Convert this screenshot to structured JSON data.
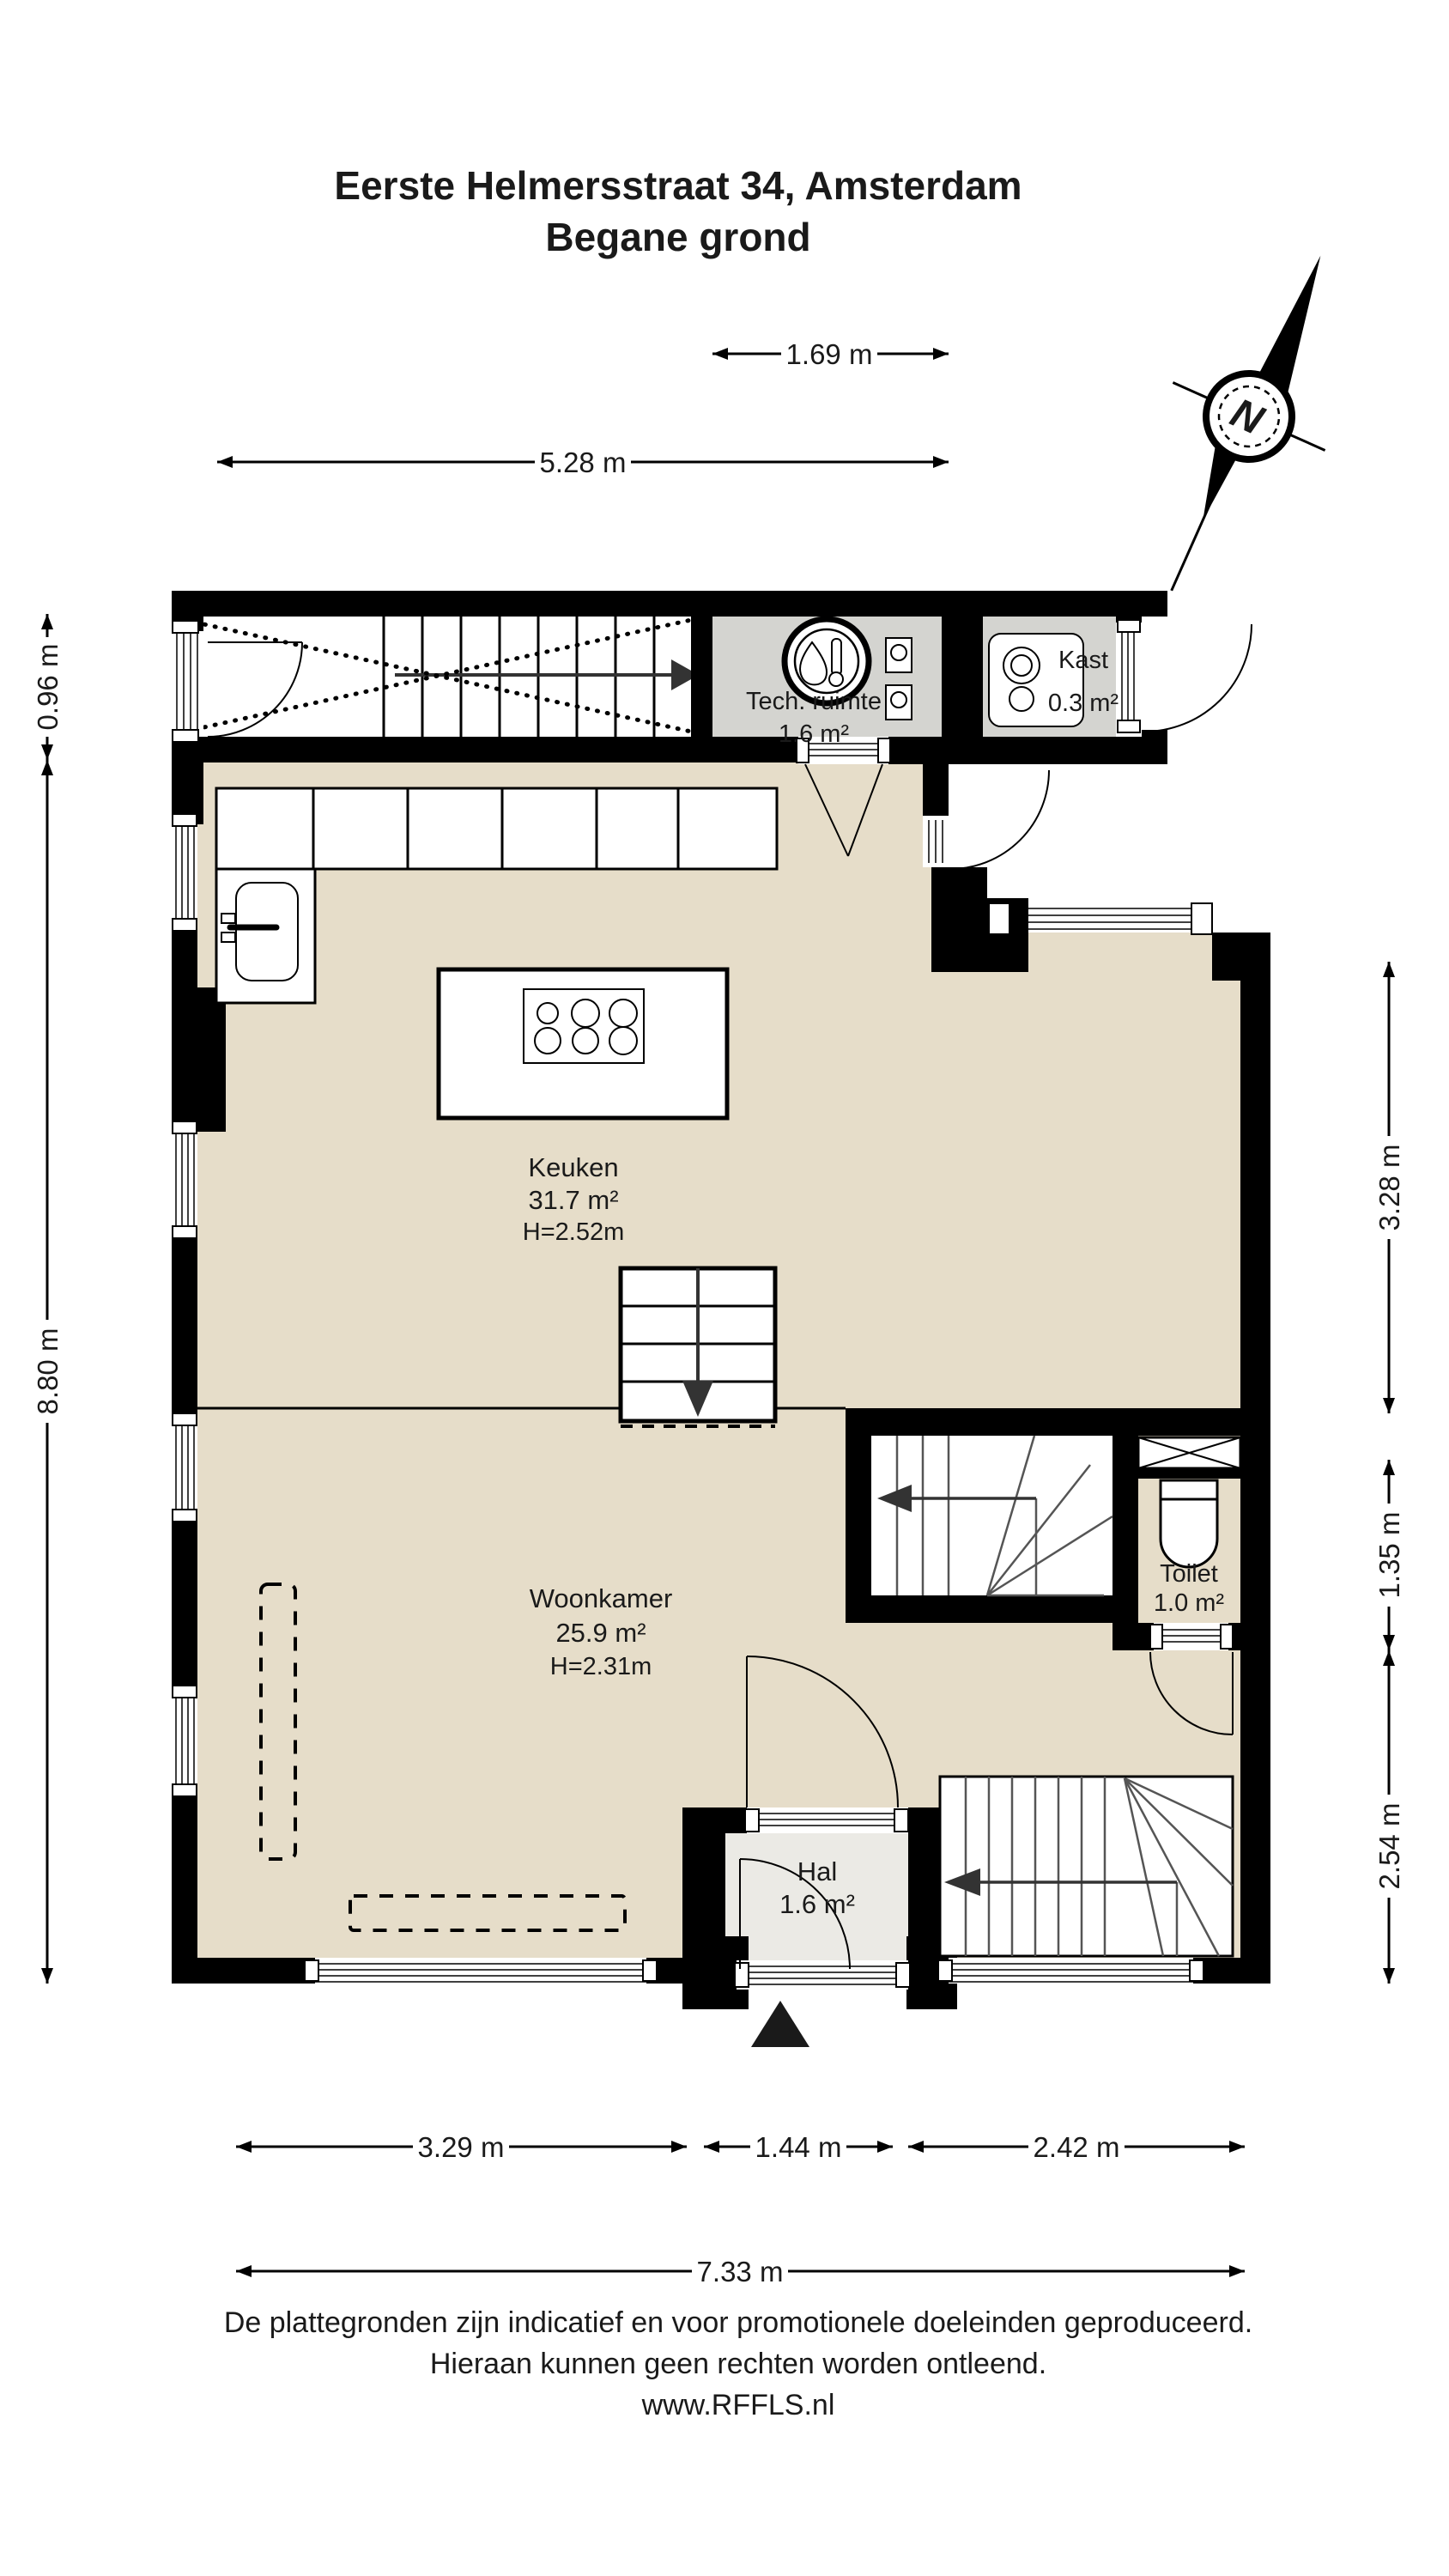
{
  "header": {
    "title_line1": "Eerste Helmersstraat 34, Amsterdam",
    "title_line2": "Begane grond"
  },
  "compass": {
    "north_label": "N"
  },
  "rooms": {
    "tech_ruimte": {
      "name": "Tech. ruimte",
      "area": "1.6 m²"
    },
    "kast": {
      "name": "Kast",
      "area": "0.3 m²"
    },
    "keuken": {
      "name": "Keuken",
      "area": "31.7 m²",
      "height": "H=2.52m"
    },
    "woonkamer": {
      "name": "Woonkamer",
      "area": "25.9 m²",
      "height": "H=2.31m"
    },
    "toilet": {
      "name": "Toilet",
      "area": "1.0 m²"
    },
    "hal": {
      "name": "Hal",
      "area": "1.6 m²"
    }
  },
  "dimensions": {
    "top_inner": {
      "label": "1.69 m"
    },
    "top_overall": {
      "label": "5.28 m"
    },
    "left_upper": {
      "label": "0.96 m"
    },
    "left_overall": {
      "label": "8.80 m"
    },
    "right_upper": {
      "label": "3.28 m"
    },
    "right_middle": {
      "label": "1.35 m"
    },
    "right_lower": {
      "label": "2.54 m"
    },
    "bottom_left": {
      "label": "3.29 m"
    },
    "bottom_center": {
      "label": "1.44 m"
    },
    "bottom_right": {
      "label": "2.42 m"
    },
    "bottom_overall": {
      "label": "7.33 m"
    }
  },
  "footer": {
    "line1": "De plattegronden zijn indicatief en voor promotionele doeleinden geproduceerd.",
    "line2": "Hieraan kunnen geen rechten worden ontleend.",
    "line3": "www.RFFLS.nl"
  },
  "colors": {
    "wall": "#000000",
    "floor_main": "#e6ddc9",
    "floor_gray": "#d4d4d0",
    "floor_hal": "#ebeae5",
    "floor_white": "#ffffff"
  }
}
